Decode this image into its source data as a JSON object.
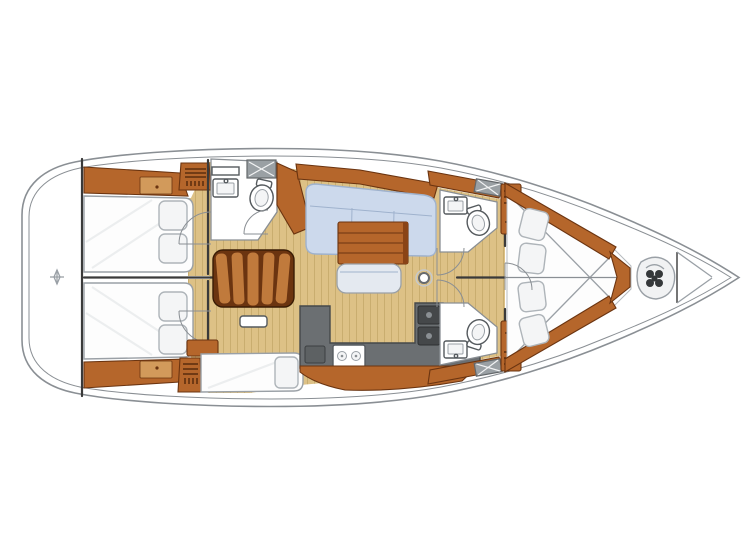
{
  "page": {
    "background": "#ffffff",
    "alt": "Top-down interior layout plan of a sailing yacht, bow pointing right"
  },
  "colors": {
    "page": "#ffffff",
    "hull": "#ffffff",
    "hull-line": "#8a8f94",
    "wall": "#3a3a3a",
    "wood": "#b5662b",
    "wood-dark": "#6b3410",
    "wood-light": "#d29a5b",
    "wood-slat": "#c07a3c",
    "floor": "#ddc186",
    "floor-line": "#c9ad6f",
    "berth": "#fdfdfd",
    "berth-line": "#9aa0a6",
    "pillow": "#f4f5f6",
    "pillow-line": "#aeb4b9",
    "settee": "#ccd9ec",
    "settee-line": "#9fb2cd",
    "bench": "#e4e9f0",
    "counter": "#6b6f72",
    "counter-dark": "#45484a",
    "hatch": "#9aa0a4"
  },
  "boat": {
    "type": "yacht-deck-plan",
    "orientation": "bow-right",
    "areas": [
      {
        "id": "swim-platform",
        "label": "Transom swim platform"
      },
      {
        "id": "aft-cabin-port",
        "label": "Aft double cabin port",
        "features": [
          "double-berth",
          "two-pillows",
          "side-shelf",
          "louvered-locker"
        ]
      },
      {
        "id": "aft-cabin-starboard",
        "label": "Aft double cabin starboard",
        "features": [
          "double-berth",
          "two-pillows",
          "side-shelf",
          "louvered-locker",
          "single-berth"
        ]
      },
      {
        "id": "aft-head",
        "label": "Aft head with washbasin and toilet"
      },
      {
        "id": "companionway",
        "label": "Companionway steps"
      },
      {
        "id": "salon",
        "label": "Salon with L-settee, folding table and bench"
      },
      {
        "id": "galley",
        "label": "L-shaped galley with stove, sink and fridge"
      },
      {
        "id": "head-port",
        "label": "Midship head port with washbasin and toilet"
      },
      {
        "id": "head-starboard",
        "label": "Midship head starboard with washbasin and toilet"
      },
      {
        "id": "forward-cabin",
        "label": "Forward V-berth cabin with side cushions"
      },
      {
        "id": "bow-locker",
        "label": "Bow anchor locker with windlass"
      }
    ],
    "fixtures": {
      "toilets": 3,
      "sinks": 3,
      "stove_burners": 2,
      "mast_posts": 1
    }
  }
}
